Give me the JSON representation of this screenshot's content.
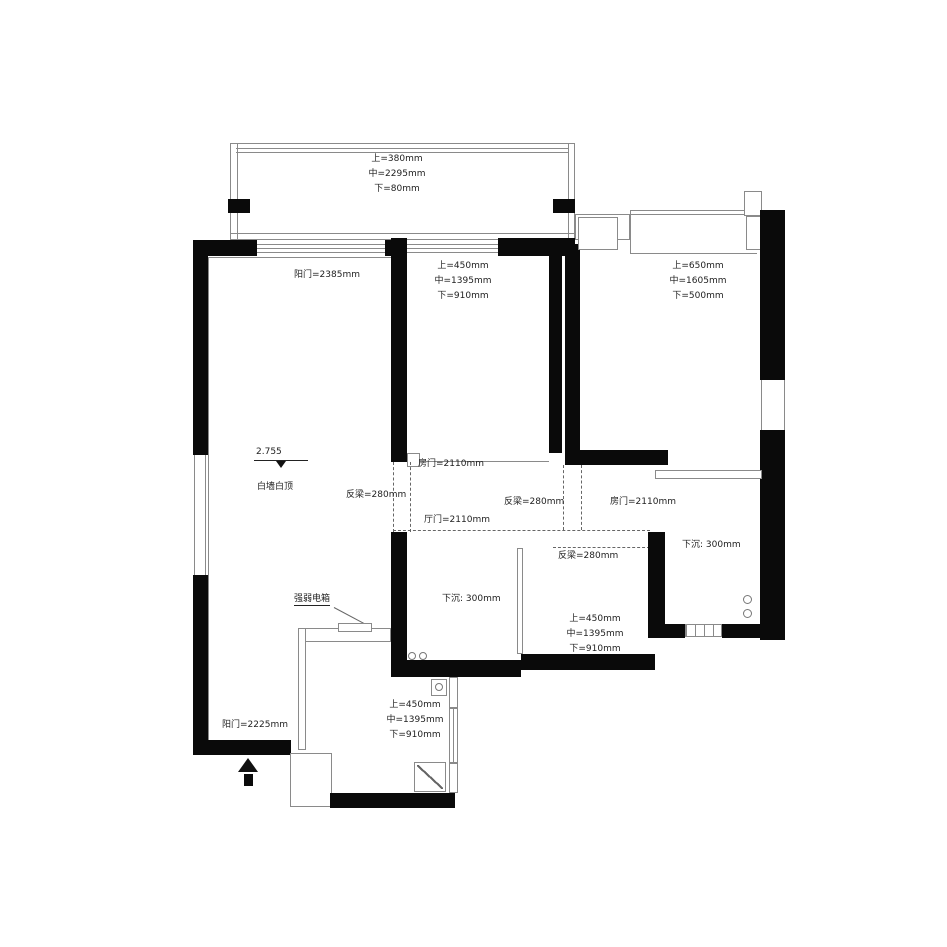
{
  "annotations": {
    "balcony_window": [
      "上=380mm",
      "中=2295mm",
      "下=80mm"
    ],
    "balcony_door": "阳门=2385mm",
    "bedroom2_window": [
      "上=450mm",
      "中=1395mm",
      "下=910mm"
    ],
    "bedroom1_window": [
      "上=650mm",
      "中=1605mm",
      "下=500mm"
    ],
    "elevation": "2.755",
    "wall_finish": "白墙白顶",
    "bedroom2_door": "房门=2110mm",
    "beam_left": "反梁=280mm",
    "living_door": "厅门=2110mm",
    "beam_mid": "反梁=280mm",
    "bathroom_door": "房门=2110mm",
    "beam_right": "反梁=280mm",
    "sunken_bath": "下沉: 300mm",
    "sunken_shower": "下沉: 300mm",
    "midroom_window": [
      "上=450mm",
      "中=1395mm",
      "下=910mm"
    ],
    "electric_box": "强弱电箱",
    "entry_window": [
      "上=450mm",
      "中=1395mm",
      "下=910mm"
    ],
    "entry_door": "阳门=2225mm"
  },
  "colors": {
    "wall": "#0a0a0a",
    "thin_line": "#8a8a8a",
    "text": "#222222"
  }
}
